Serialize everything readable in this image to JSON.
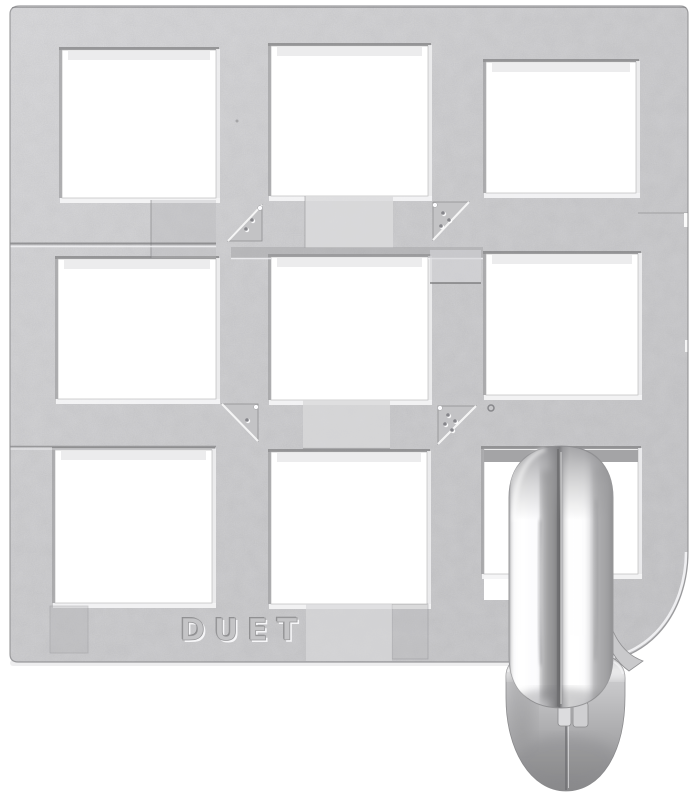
{
  "meta": {
    "subject": "Chrome cast-metal grid puzzle with polished ring threaded through lower-right cell",
    "background_color": "#ffffff"
  },
  "brand": {
    "embossed_text": "DUET"
  },
  "puzzle": {
    "grid": {
      "rows": 3,
      "cols": 3,
      "hole_count": 9
    },
    "finish": {
      "plate": "matte sandblasted silver",
      "ring": "polished chrome, two half-rings with center seam"
    },
    "colors": {
      "plate_base": "#cbcbcd",
      "plate_highlight": "#f4f4f6",
      "plate_shadow": "#7d7d7f",
      "ring_highlight": "#ffffff",
      "ring_shadow": "#6f6f71"
    },
    "holes": [
      {
        "x": 62,
        "y": 50,
        "w": 154,
        "h": 148
      },
      {
        "x": 271,
        "y": 46,
        "w": 157,
        "h": 150
      },
      {
        "x": 486,
        "y": 62,
        "w": 150,
        "h": 131
      },
      {
        "x": 58,
        "y": 259,
        "w": 158,
        "h": 140
      },
      {
        "x": 271,
        "y": 257,
        "w": 157,
        "h": 143
      },
      {
        "x": 486,
        "y": 254,
        "w": 152,
        "h": 141
      },
      {
        "x": 55,
        "y": 450,
        "w": 157,
        "h": 153
      },
      {
        "x": 271,
        "y": 452,
        "w": 156,
        "h": 152
      },
      {
        "x": 484,
        "y": 449,
        "w": 154,
        "h": 125
      }
    ],
    "gate_markers": [
      {
        "corner": "upper-left",
        "dots": 2,
        "points": "228,241 262,241 262,205",
        "bright_edge": [
          228,
          241,
          262,
          205
        ],
        "dot_positions": [
          [
            246,
            229
          ],
          [
            252,
            220
          ]
        ],
        "apex": [
          260,
          208
        ]
      },
      {
        "corner": "upper-right",
        "dots": 3,
        "points": "433,202 469,202 433,240",
        "bright_edge": [
          469,
          202,
          433,
          240
        ],
        "dot_positions": [
          [
            443,
            213
          ],
          [
            449,
            220
          ],
          [
            441,
            226
          ]
        ],
        "apex": [
          435,
          205
        ]
      },
      {
        "corner": "lower-left",
        "dots": 1,
        "points": "222,404 258,404 258,441",
        "bright_edge": [
          222,
          404,
          258,
          441
        ],
        "dot_positions": [
          [
            247,
            420
          ]
        ],
        "apex": [
          256,
          407
        ]
      },
      {
        "corner": "lower-right",
        "dots": 4,
        "points": "438,406 476,406 438,444",
        "bright_edge": [
          476,
          406,
          438,
          444
        ],
        "dot_positions": [
          [
            448,
            415
          ],
          [
            455,
            421
          ],
          [
            445,
            424
          ],
          [
            452,
            430
          ]
        ],
        "apex": [
          440,
          408
        ]
      }
    ],
    "ring": {
      "visible_halves": 2,
      "center_seam": true,
      "bottom_loop_below_plate": true
    }
  }
}
